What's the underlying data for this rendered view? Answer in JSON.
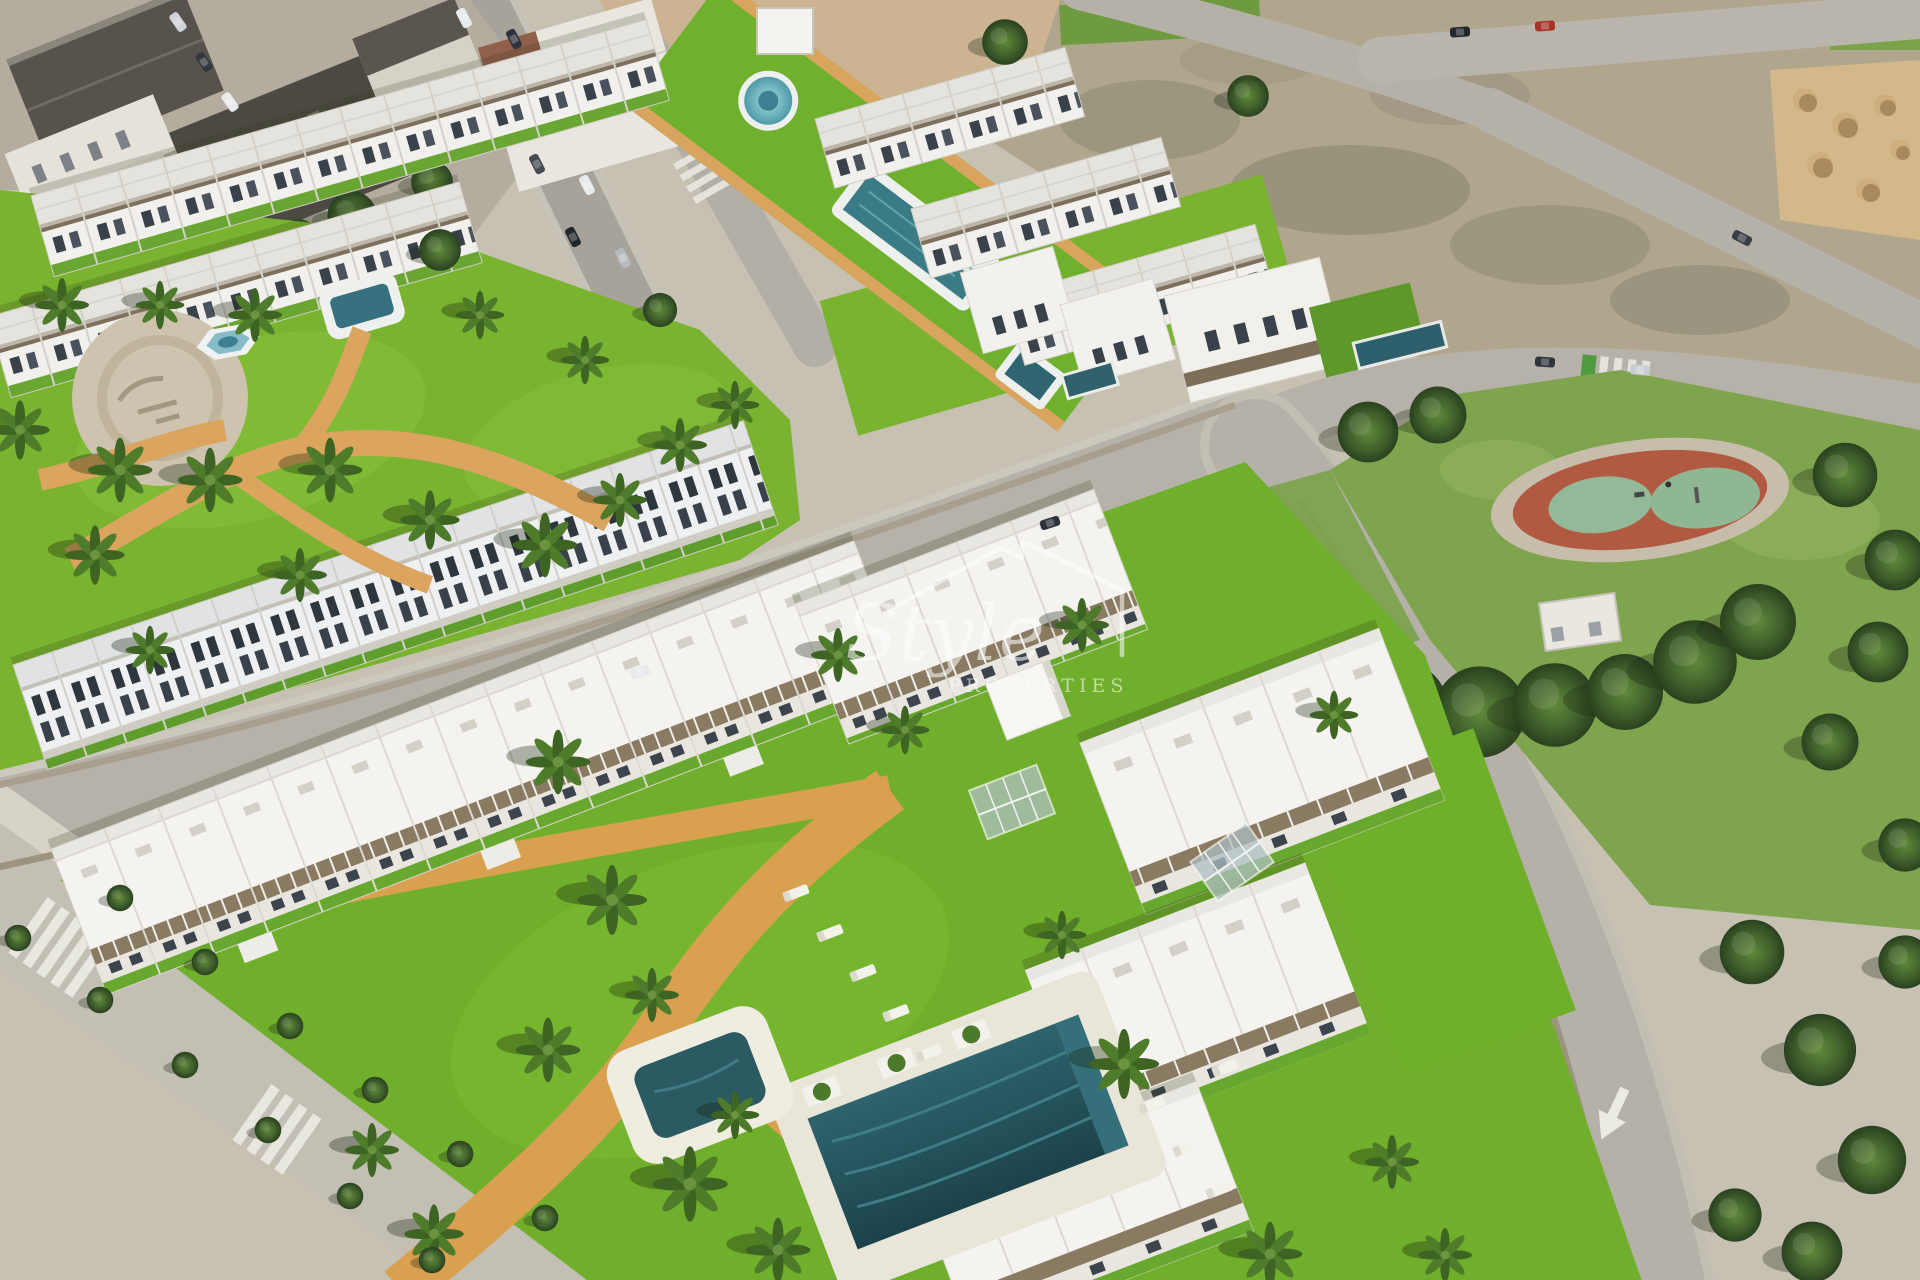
{
  "watermark": {
    "brand_script": "Style",
    "brand_caps": "PROPERTIES",
    "icon": "house-outline-icon",
    "color": "#ffffff",
    "opacity": 0.55
  },
  "scene": {
    "type": "aerial-3d-render",
    "subject": "new-build residential complex beside an existing town",
    "areas": [
      {
        "name": "existing-town",
        "position": "top-left",
        "features": [
          "dark pitched roofs",
          "street with parked cars"
        ]
      },
      {
        "name": "phase1-townhouses",
        "position": "top-center",
        "features": [
          "rows of white townhouses",
          "garden plaza",
          "hexagonal fountain",
          "garden pool"
        ]
      },
      {
        "name": "central-amenity-strip",
        "pools": [
          "round-splash-pool",
          "lap-pool",
          "plunge-pool"
        ]
      },
      {
        "name": "vacant-dirt-lots",
        "position": "top-right",
        "features": [
          "scrub ground",
          "sand stockpiles"
        ]
      },
      {
        "name": "public-park",
        "position": "middle-right",
        "features": [
          "dense trees",
          "red playground with green safety pads",
          "utility-building"
        ]
      },
      {
        "name": "phase2-apartments",
        "position": "bottom",
        "features": [
          "white apartment blocks",
          "communal lawn",
          "main-pool",
          "kids-pool",
          "sun-loungers",
          "glass-pergolas",
          "sand paths",
          "palm trees"
        ]
      },
      {
        "name": "roads",
        "features": [
          "crosswalks",
          "parked-cars",
          "lane-arrow-marking",
          "street-trees"
        ]
      }
    ]
  },
  "palette": {
    "pavement": "#c7c1b4",
    "road": "#b6b2a9",
    "grass_bright": "#72b02a",
    "grass_park": "#7fa44e",
    "tree_dark": "#2c431f",
    "dirt": "#b0a68e",
    "sand_piles": "#d3b88b",
    "path_sand": "#d9a050",
    "pool_dark": "#275a62",
    "pool_light": "#8fd6da",
    "building_white": "#f4f3ef",
    "town_roof_dark": "#4c4943",
    "playground_red": "#b25a41",
    "playground_green": "#8fb794",
    "watermark": "#ffffff"
  }
}
